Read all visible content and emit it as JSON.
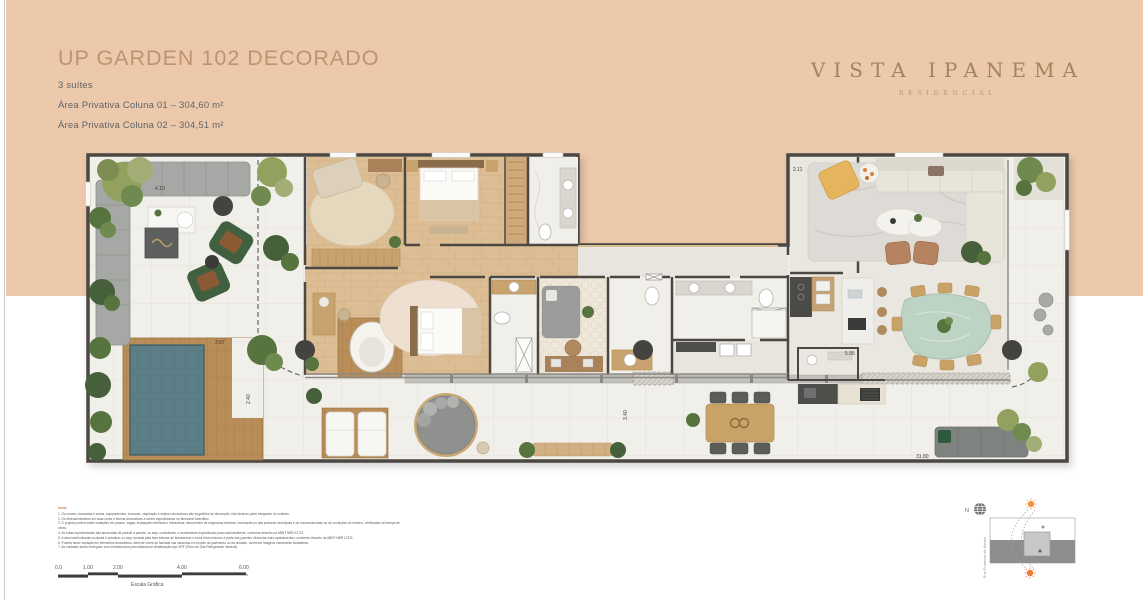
{
  "colors": {
    "peach": "#edc9ab",
    "title_gold": "#c09270",
    "logo_brown": "#a3845c",
    "subtitle_gray": "#5f6468",
    "pool_teal": "#5d7f87",
    "wall_dark": "#4b4743"
  },
  "header": {
    "title": "UP GARDEN 102 DECORADO",
    "suites": "3 suítes",
    "area1": "Área Privativa Coluna 01 – 304,60 m²",
    "area2": "Área Privativa Coluna 02 – 304,51 m²"
  },
  "brand": {
    "name": "VISTA IPANEMA",
    "tagline": "RESIDENCIAL"
  },
  "plan": {
    "dims": [
      {
        "t": "4.10"
      },
      {
        "t": "3.87"
      },
      {
        "t": "2.40"
      },
      {
        "t": "3.40"
      },
      {
        "t": "2.11"
      },
      {
        "t": "5.95"
      },
      {
        "t": "31.80"
      }
    ]
  },
  "notes": {
    "heading": "Notas:",
    "items": [
      "1. Os móveis, bancadas e cubas, equipamentos, enxovais, vegetação e objetos decorativos são sugestões de decoração, não fazendo parte integrante do contrato.",
      "2. Os eletrodomésticos em suas cores e formas decorativas a serem especificados no Memorial Descritivo.",
      "3. O projeto poderá sofrer variações em prazos, vagas, instalações elétricas e hidráulicas, decorrentes de exigências técnicas, estruturais ou das posturas municipais e de concessionárias ou de condições do entorno, verificadas na licença de obras.",
      "4. As cotas representadas são amarradas de parede a parede, ou seja, consideram o revestimento especificado para cada ambiente, conforme descrito na ABNT NBR 12721.",
      "5. A área total indicada na planta é privativa, ou seja, tomada pela face externa de fechamento e inclui eixos internos e parte das paredes divisórias entre apartamentos, conforme descrito na ABNT NBR 12721.",
      "6. Poderá haver variação em elementos decorativos, além de cores da fachada nas varandas em função do pavimento ou da unidade, conforme imagens meramente ilustrativas.",
      "7. As unidades serão entregues com infraestrutura para sistema de climatização tipo VRF (Fluxo de Gás Refrigerante Variável)."
    ]
  },
  "scalebar": {
    "ticks": [
      "0.0",
      "1.00",
      "2.00",
      "4.00",
      "6.00"
    ],
    "label": "Escala Gráfica"
  },
  "keyplan": {
    "north_label": "N",
    "street_label": "Rua Prudente de Morais"
  }
}
